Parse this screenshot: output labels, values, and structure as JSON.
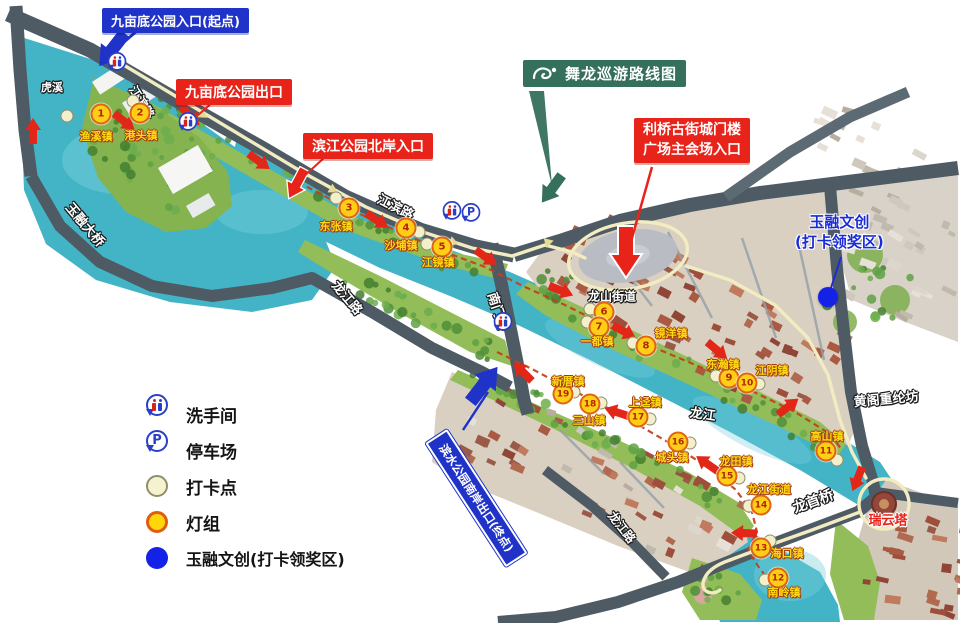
{
  "title_banner": {
    "label": "舞龙巡游路线图"
  },
  "callouts": {
    "entrance": "九亩底公园入口(起点)",
    "park_exit": "九亩底公园出口",
    "north_bank_entrance": "滨江公园北岸入口",
    "main_venue_line1": "利桥古街城门楼",
    "main_venue_line2": "广场主会场入口",
    "south_exit": "滨水公园南岸出口(终点)",
    "award_area_line1": "玉融文创",
    "award_area_line2": "(打卡领奖区)"
  },
  "legend": {
    "items": [
      {
        "icon": "toilet-pin-icon",
        "label": "洗手间"
      },
      {
        "icon": "parking-pin-icon",
        "label": "停车场"
      },
      {
        "icon": "checkpoint-dot-icon",
        "label": "打卡点"
      },
      {
        "icon": "lamp-dot-icon",
        "label": "灯组"
      },
      {
        "icon": "award-dot-icon",
        "label": "玉融文创(打卡领奖区)"
      }
    ]
  },
  "stops": [
    {
      "num": "1",
      "name": "渔溪镇",
      "x": 101,
      "y": 114,
      "lx": 96,
      "ly": 136,
      "px": 67,
      "py": 116
    },
    {
      "num": "2",
      "name": "港头镇",
      "x": 140,
      "y": 113,
      "lx": 141,
      "ly": 135,
      "px": 133,
      "py": 101
    },
    {
      "num": "3",
      "name": "东张镇",
      "x": 349,
      "y": 208,
      "lx": 336,
      "ly": 226,
      "px": 336,
      "py": 198
    },
    {
      "num": "4",
      "name": "沙埔镇",
      "x": 406,
      "y": 228,
      "lx": 401,
      "ly": 245,
      "px": 419,
      "py": 232
    },
    {
      "num": "5",
      "name": "江镜镇",
      "x": 442,
      "y": 247,
      "lx": 438,
      "ly": 262,
      "px": 427,
      "py": 244
    },
    {
      "num": "6",
      "name": "",
      "x": 604,
      "y": 312,
      "lx": 0,
      "ly": 0,
      "px": 590,
      "py": 309
    },
    {
      "num": "7",
      "name": "一都镇",
      "x": 599,
      "y": 327,
      "lx": 597,
      "ly": 341,
      "px": 587,
      "py": 322
    },
    {
      "num": "8",
      "name": "镜洋镇",
      "x": 646,
      "y": 346,
      "lx": 671,
      "ly": 333,
      "px": 633,
      "py": 343
    },
    {
      "num": "9",
      "name": "东瀚镇",
      "x": 729,
      "y": 378,
      "lx": 723,
      "ly": 364,
      "px": 716,
      "py": 376
    },
    {
      "num": "10",
      "name": "江阴镇",
      "x": 747,
      "y": 383,
      "lx": 772,
      "ly": 370,
      "px": 759,
      "py": 384
    },
    {
      "num": "11",
      "name": "高山镇",
      "x": 826,
      "y": 451,
      "lx": 827,
      "ly": 436,
      "px": 837,
      "py": 460
    },
    {
      "num": "12",
      "name": "南岭镇",
      "x": 778,
      "y": 578,
      "lx": 784,
      "ly": 592,
      "px": 765,
      "py": 580
    },
    {
      "num": "13",
      "name": "海口镇",
      "x": 761,
      "y": 548,
      "lx": 787,
      "ly": 553,
      "px": 770,
      "py": 541
    },
    {
      "num": "14",
      "name": "龙江街道",
      "x": 761,
      "y": 505,
      "lx": 769,
      "ly": 489,
      "px": 749,
      "py": 506
    },
    {
      "num": "15",
      "name": "龙田镇",
      "x": 727,
      "y": 476,
      "lx": 736,
      "ly": 461,
      "px": 739,
      "py": 478
    },
    {
      "num": "16",
      "name": "城头镇",
      "x": 678,
      "y": 442,
      "lx": 672,
      "ly": 457,
      "px": 690,
      "py": 443
    },
    {
      "num": "17",
      "name": "上迳镇",
      "x": 638,
      "y": 417,
      "lx": 645,
      "ly": 402,
      "px": 650,
      "py": 419
    },
    {
      "num": "18",
      "name": "三山镇",
      "x": 590,
      "y": 404,
      "lx": 589,
      "ly": 420,
      "px": 601,
      "py": 403
    },
    {
      "num": "19",
      "name": "新厝镇",
      "x": 563,
      "y": 394,
      "lx": 568,
      "ly": 381,
      "px": 574,
      "py": 392
    }
  ],
  "map_labels": [
    {
      "text": "虎溪",
      "x": 52,
      "y": 87,
      "rot": 0,
      "size": 11,
      "style": "white"
    },
    {
      "text": "玉融大桥",
      "x": 86,
      "y": 224,
      "rot": 50,
      "size": 13,
      "style": "white"
    },
    {
      "text": "江滨路",
      "x": 142,
      "y": 102,
      "rot": 58,
      "size": 12,
      "style": "white"
    },
    {
      "text": "江滨路",
      "x": 396,
      "y": 206,
      "rot": 27,
      "size": 13,
      "style": "white"
    },
    {
      "text": "龙江路",
      "x": 348,
      "y": 297,
      "rot": 50,
      "size": 13,
      "style": "white"
    },
    {
      "text": "南门桥",
      "x": 499,
      "y": 311,
      "rot": 72,
      "size": 13,
      "style": "white"
    },
    {
      "text": "龙山街道",
      "x": 612,
      "y": 296,
      "rot": 0,
      "size": 12,
      "style": "white"
    },
    {
      "text": "龙江",
      "x": 703,
      "y": 413,
      "rot": 8,
      "size": 13,
      "style": "white"
    },
    {
      "text": "龙江路",
      "x": 622,
      "y": 527,
      "rot": 52,
      "size": 12,
      "style": "white"
    },
    {
      "text": "龙首桥",
      "x": 813,
      "y": 501,
      "rot": -20,
      "size": 14,
      "style": "white"
    },
    {
      "text": "黄阁重纶坊",
      "x": 886,
      "y": 398,
      "rot": -5,
      "size": 13,
      "style": "white"
    },
    {
      "text": "瑞云塔",
      "x": 888,
      "y": 519,
      "rot": 0,
      "size": 13,
      "style": "red"
    }
  ],
  "facilities": {
    "toilets": [
      {
        "x": 117,
        "y": 85
      },
      {
        "x": 188,
        "y": 145
      },
      {
        "x": 452,
        "y": 234
      },
      {
        "x": 503,
        "y": 345
      }
    ],
    "parking": [
      {
        "x": 471,
        "y": 236
      }
    ],
    "award_point": {
      "x": 828,
      "y": 297
    }
  },
  "colors": {
    "water": "#43b4c6",
    "park_green": "#93bd58",
    "road": "#4e5b64",
    "banner_red": "#e8231a",
    "banner_blue": "#2033c8",
    "banner_green": "#35705c",
    "route_cream": "#f2ecc2",
    "route_red": "#c2401c",
    "stop_fill": "#ffce17",
    "stop_border": "#e06414",
    "award_blue": "#1422e8"
  }
}
